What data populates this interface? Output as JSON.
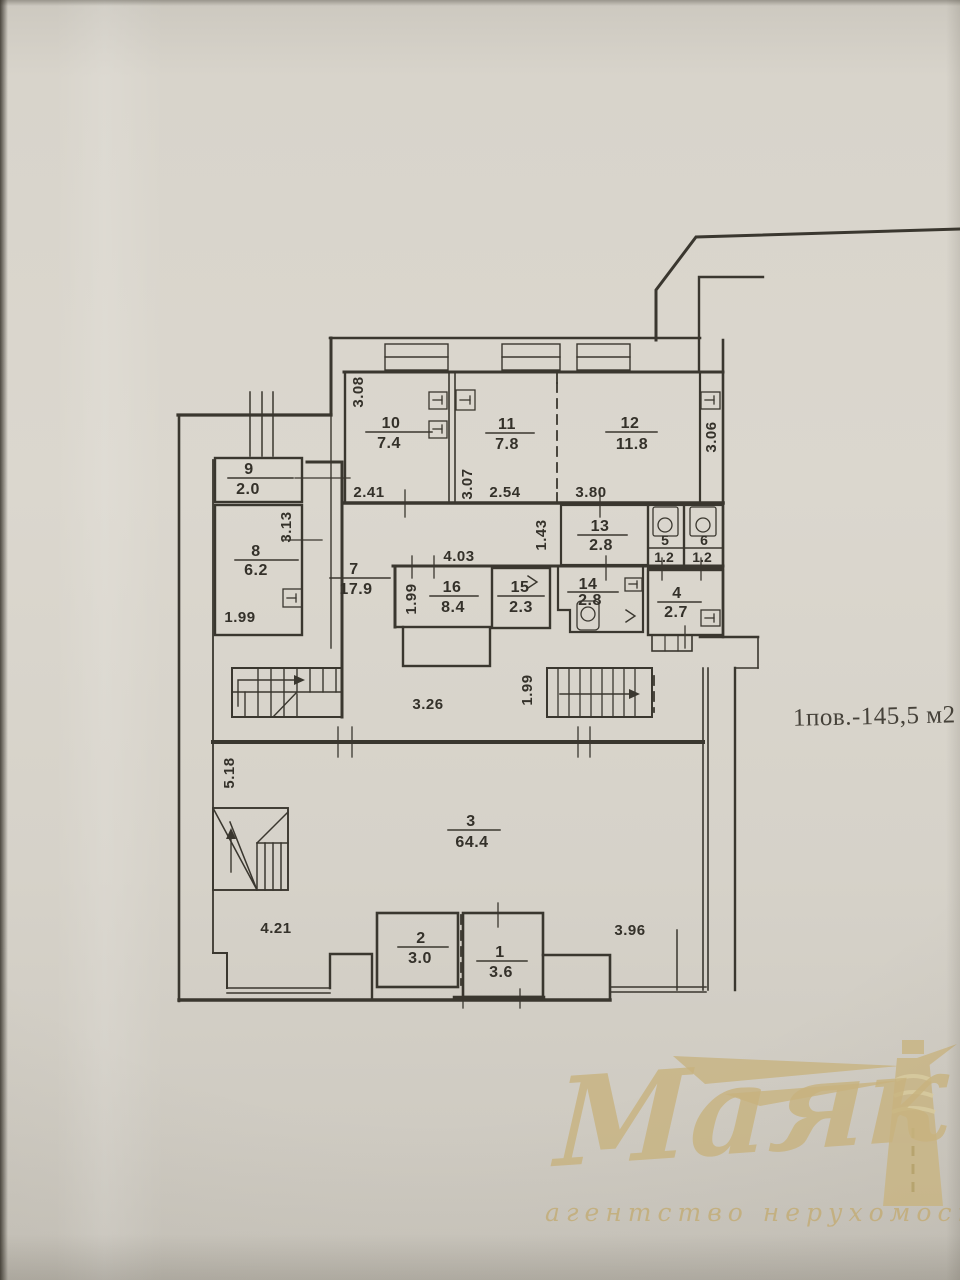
{
  "note": {
    "floor_summary": "1пов.-145,5 м2"
  },
  "watermark": {
    "brand": "Маяк",
    "tagline": "агентство нерухомості",
    "gold": "#c8b37f"
  },
  "plan": {
    "colors": {
      "ink": "#3a372f",
      "paper": "#d7d3ca"
    },
    "rooms": [
      {
        "number": "1",
        "area": "3.6"
      },
      {
        "number": "2",
        "area": "3.0"
      },
      {
        "number": "3",
        "area": "64.4"
      },
      {
        "number": "4",
        "area": "2.7"
      },
      {
        "number": "5",
        "area": "1.2"
      },
      {
        "number": "6",
        "area": "1.2"
      },
      {
        "number": "7",
        "area": "17.9"
      },
      {
        "number": "8",
        "area": "6.2"
      },
      {
        "number": "9",
        "area": "2.0"
      },
      {
        "number": "10",
        "area": "7.4"
      },
      {
        "number": "11",
        "area": "7.8"
      },
      {
        "number": "12",
        "area": "11.8"
      },
      {
        "number": "13",
        "area": "2.8"
      },
      {
        "number": "14",
        "area": "2.8"
      },
      {
        "number": "15",
        "area": "2.3"
      },
      {
        "number": "16",
        "area": "8.4"
      }
    ],
    "dimensions": [
      {
        "value": "3.08"
      },
      {
        "value": "2.41"
      },
      {
        "value": "3.07"
      },
      {
        "value": "2.54"
      },
      {
        "value": "3.80"
      },
      {
        "value": "3.06"
      },
      {
        "value": "1.43"
      },
      {
        "value": "3.13"
      },
      {
        "value": "1.99"
      },
      {
        "value": "4.03"
      },
      {
        "value": "1.99"
      },
      {
        "value": "1.99"
      },
      {
        "value": "3.26"
      },
      {
        "value": "5.18"
      },
      {
        "value": "4.21"
      },
      {
        "value": "3.96"
      }
    ]
  }
}
